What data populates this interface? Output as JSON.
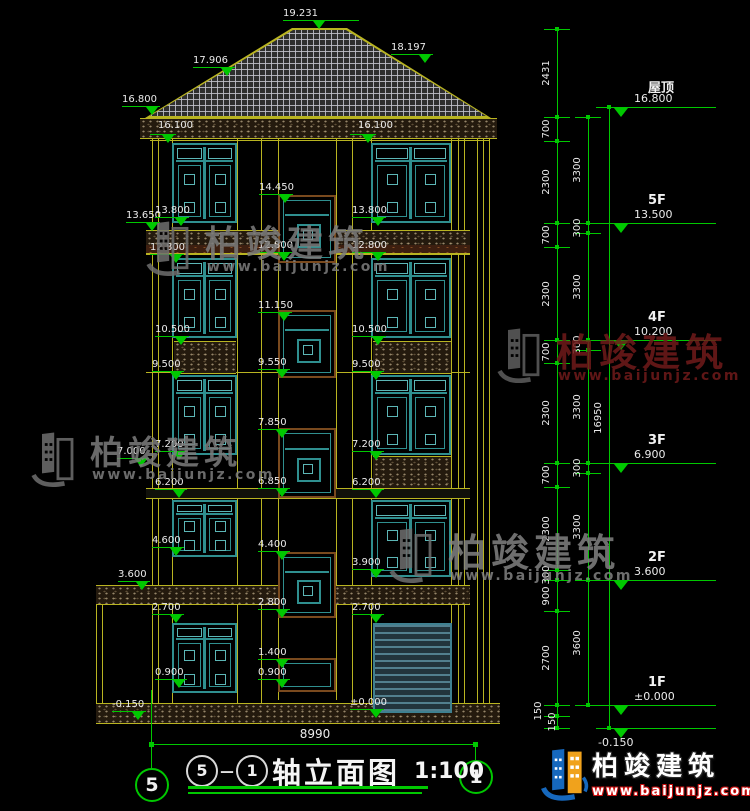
{
  "colors": {
    "bg": "#000000",
    "line_yellow": "#b9b421",
    "green": "#00c800",
    "text": "#ebebeb",
    "teal": "#2f8f8f",
    "teal_light": "#5cb6b6",
    "brown": "#7a4a1e",
    "maroon": "#701a1a",
    "gray_wm": "#7d7d7d",
    "logo_blue": "#1668bd",
    "logo_orange": "#f0a21c",
    "logo_red": "#cc1111"
  },
  "title_block": {
    "axis_left": "5",
    "dash": "－",
    "axis_right": "1",
    "name": "轴立面图",
    "scale": "1:100"
  },
  "axis_bubbles": {
    "left": "5",
    "right": "1"
  },
  "bottom_dim": "8990",
  "logo": {
    "text": "柏竣建筑",
    "url": "www.baijunjz.com"
  },
  "watermarks": [
    {
      "x": 143,
      "y": 213,
      "color": "#7d7d7d",
      "logo_color": "#6f6f6f",
      "fs": 36,
      "text": "柏竣建筑",
      "url": "www.baijunjz.com"
    },
    {
      "x": 28,
      "y": 424,
      "color": "#7d7d7d",
      "logo_color": "#6f6f6f",
      "fs": 33,
      "text": "柏竣建筑",
      "url": "www.baijunjz.com"
    },
    {
      "x": 494,
      "y": 320,
      "color": "#701a1a",
      "logo_color": "#5e5e5e",
      "fs": 38,
      "text": "柏竣建筑",
      "url": "www.baijunjz.com"
    },
    {
      "x": 386,
      "y": 520,
      "color": "#828282",
      "logo_color": "#6f6f6f",
      "fs": 38,
      "text": "柏竣建筑",
      "url": "www.baijunjz.com"
    }
  ],
  "elevation_marks": [
    {
      "t": "19.231",
      "x": 283,
      "y": 8,
      "w": 76,
      "to": 30
    },
    {
      "t": "17.906",
      "x": 193,
      "y": 55,
      "w": 42,
      "to": 28
    },
    {
      "t": "18.197",
      "x": 391,
      "y": 42,
      "w": 42,
      "to": 28
    },
    {
      "t": "16.800",
      "x": 122,
      "y": 94,
      "w": 38,
      "to": 24
    },
    {
      "t": "16.100",
      "x": 158,
      "y": 120,
      "plain": true
    },
    {
      "t": "16.100",
      "x": 358,
      "y": 120,
      "plain": true
    },
    {
      "t": "",
      "x": 150,
      "y": 122,
      "w": 26,
      "to": 12
    },
    {
      "t": "",
      "x": 350,
      "y": 122,
      "w": 26,
      "to": 12
    },
    {
      "t": "14.450",
      "x": 259,
      "y": 182,
      "w": 34
    },
    {
      "t": "13.650",
      "x": 126,
      "y": 210,
      "w": 34
    },
    {
      "t": "13.800",
      "x": 155,
      "y": 205,
      "w": 34
    },
    {
      "t": "13.800",
      "x": 352,
      "y": 205,
      "w": 34
    },
    {
      "t": "12.800",
      "x": 150,
      "y": 242,
      "w": 34
    },
    {
      "t": "12.800",
      "x": 258,
      "y": 240,
      "w": 34
    },
    {
      "t": "12.800",
      "x": 352,
      "y": 240,
      "w": 34
    },
    {
      "t": "11.150",
      "x": 258,
      "y": 300,
      "w": 34
    },
    {
      "t": "10.500",
      "x": 155,
      "y": 324,
      "w": 34
    },
    {
      "t": "10.500",
      "x": 352,
      "y": 324,
      "w": 34
    },
    {
      "t": "9.500",
      "x": 152,
      "y": 359,
      "w": 32
    },
    {
      "t": "9.550",
      "x": 258,
      "y": 357,
      "w": 32
    },
    {
      "t": "9.500",
      "x": 352,
      "y": 359,
      "w": 32
    },
    {
      "t": "7.850",
      "x": 258,
      "y": 417,
      "w": 32
    },
    {
      "t": "7.000",
      "x": 117,
      "y": 446,
      "w": 32
    },
    {
      "t": "7.200",
      "x": 155,
      "y": 439,
      "w": 32
    },
    {
      "t": "7.200",
      "x": 352,
      "y": 439,
      "w": 32
    },
    {
      "t": "6.200",
      "x": 155,
      "y": 477,
      "w": 32
    },
    {
      "t": "6.850",
      "x": 258,
      "y": 476,
      "w": 32
    },
    {
      "t": "6.200",
      "x": 352,
      "y": 477,
      "w": 32
    },
    {
      "t": "4.600",
      "x": 152,
      "y": 535,
      "w": 32
    },
    {
      "t": "4.400",
      "x": 258,
      "y": 539,
      "w": 32
    },
    {
      "t": "3.900",
      "x": 352,
      "y": 557,
      "w": 32
    },
    {
      "t": "3.600",
      "x": 118,
      "y": 569,
      "w": 32
    },
    {
      "t": "2.700",
      "x": 152,
      "y": 602,
      "w": 32
    },
    {
      "t": "2.800",
      "x": 258,
      "y": 597,
      "w": 32
    },
    {
      "t": "2.700",
      "x": 352,
      "y": 602,
      "w": 32
    },
    {
      "t": "1.400",
      "x": 258,
      "y": 647,
      "w": 32
    },
    {
      "t": "0.900",
      "x": 155,
      "y": 667,
      "w": 32
    },
    {
      "t": "0.900",
      "x": 258,
      "y": 667,
      "w": 32
    },
    {
      "t": "-0.150",
      "x": 112,
      "y": 699,
      "w": 34
    },
    {
      "t": "±0.000",
      "x": 350,
      "y": 697,
      "w": 34
    }
  ],
  "floor_levels": [
    {
      "label": "屋顶",
      "elev": "16.800",
      "ly": 107
    },
    {
      "label": "5F",
      "elev": "13.500",
      "ly": 223
    },
    {
      "label": "4F",
      "elev": "10.200",
      "ly": 340
    },
    {
      "label": "3F",
      "elev": "6.900",
      "ly": 463
    },
    {
      "label": "2F",
      "elev": "3.600",
      "ly": 580
    },
    {
      "label": "1F",
      "elev": "±0.000",
      "ly": 705
    },
    {
      "label": "",
      "elev": "-0.150",
      "ly": 728,
      "below": true
    }
  ],
  "dim_chains": [
    {
      "x": 557,
      "segs": [
        {
          "t": "2431",
          "a": 29,
          "b": 117
        },
        {
          "t": "700",
          "a": 117,
          "b": 141
        },
        {
          "t": "2300",
          "a": 141,
          "b": 223
        },
        {
          "t": "700",
          "a": 223,
          "b": 247
        },
        {
          "t": "2300",
          "a": 247,
          "b": 340
        },
        {
          "t": "700",
          "a": 340,
          "b": 363
        },
        {
          "t": "2300",
          "a": 363,
          "b": 463
        },
        {
          "t": "700",
          "a": 463,
          "b": 487
        },
        {
          "t": "2300",
          "a": 487,
          "b": 570
        },
        {
          "t": "300",
          "a": 570,
          "b": 580
        },
        {
          "t": "900",
          "a": 580,
          "b": 611
        },
        {
          "t": "2700",
          "a": 611,
          "b": 705
        },
        {
          "t": "150",
          "a": 705,
          "b": 716,
          "dx": -8
        },
        {
          "t": "150",
          "a": 716,
          "b": 728,
          "dx": 6
        }
      ]
    },
    {
      "x": 588,
      "segs": [
        {
          "t": "3300",
          "a": 117,
          "b": 223
        },
        {
          "t": "300",
          "a": 223,
          "b": 233
        },
        {
          "t": "3300",
          "a": 233,
          "b": 340
        },
        {
          "t": "300",
          "a": 340,
          "b": 350
        },
        {
          "t": "3300",
          "a": 350,
          "b": 463
        },
        {
          "t": "300",
          "a": 463,
          "b": 473
        },
        {
          "t": "3300",
          "a": 473,
          "b": 580
        },
        {
          "t": "3600",
          "a": 580,
          "b": 705
        }
      ]
    },
    {
      "x": 609,
      "segs": [
        {
          "t": "16950",
          "a": 107,
          "b": 728
        }
      ]
    }
  ],
  "drawing": {
    "vlines": [
      [
        152,
        137,
        703
      ],
      [
        158,
        137,
        703
      ],
      [
        172,
        137,
        703
      ],
      [
        237,
        137,
        703
      ],
      [
        261,
        137,
        703
      ],
      [
        278,
        137,
        700
      ],
      [
        336,
        137,
        700
      ],
      [
        352,
        137,
        703
      ],
      [
        371,
        137,
        703
      ],
      [
        451,
        137,
        703
      ],
      [
        458,
        137,
        703
      ],
      [
        464,
        137,
        703
      ],
      [
        477,
        137,
        703
      ],
      [
        483,
        137,
        703
      ],
      [
        489,
        137,
        703
      ],
      [
        96,
        585,
        722
      ],
      [
        102,
        585,
        722
      ]
    ],
    "hlines": [
      [
        150,
        140,
        340
      ],
      [
        146,
        254,
        324
      ],
      [
        146,
        372,
        324
      ],
      [
        96,
        722,
        404
      ]
    ],
    "bands": [
      {
        "x": 140,
        "y": 118,
        "w": 357,
        "h": 19,
        "kind": "speckle"
      },
      {
        "x": 146,
        "y": 230,
        "w": 324,
        "h": 15,
        "kind": "speckle"
      },
      {
        "x": 146,
        "y": 245,
        "w": 324,
        "h": 8,
        "kind": "brown"
      },
      {
        "x": 174,
        "y": 341,
        "w": 62,
        "h": 31,
        "kind": "speckle"
      },
      {
        "x": 373,
        "y": 341,
        "w": 78,
        "h": 31,
        "kind": "speckle"
      },
      {
        "x": 373,
        "y": 456,
        "w": 78,
        "h": 31,
        "kind": "speckle"
      },
      {
        "x": 146,
        "y": 488,
        "w": 324,
        "h": 9,
        "kind": "thin"
      },
      {
        "x": 96,
        "y": 585,
        "w": 374,
        "h": 18,
        "kind": "speckle"
      },
      {
        "x": 96,
        "y": 703,
        "w": 404,
        "h": 19,
        "kind": "speckle"
      }
    ],
    "windows": [
      {
        "x": 172,
        "y": 143,
        "w": 65,
        "h": 80,
        "type": "large"
      },
      {
        "x": 172,
        "y": 258,
        "w": 65,
        "h": 80,
        "type": "large"
      },
      {
        "x": 172,
        "y": 375,
        "w": 65,
        "h": 80,
        "type": "large"
      },
      {
        "x": 172,
        "y": 500,
        "w": 65,
        "h": 57,
        "type": "large"
      },
      {
        "x": 172,
        "y": 623,
        "w": 65,
        "h": 70,
        "type": "large"
      },
      {
        "x": 371,
        "y": 143,
        "w": 80,
        "h": 80,
        "type": "large"
      },
      {
        "x": 371,
        "y": 258,
        "w": 80,
        "h": 80,
        "type": "large"
      },
      {
        "x": 371,
        "y": 375,
        "w": 80,
        "h": 80,
        "type": "large"
      },
      {
        "x": 371,
        "y": 500,
        "w": 80,
        "h": 77,
        "type": "large"
      },
      {
        "x": 373,
        "y": 623,
        "w": 79,
        "h": 90,
        "type": "garage"
      },
      {
        "x": 278,
        "y": 195,
        "w": 58,
        "h": 68,
        "type": "mid"
      },
      {
        "x": 278,
        "y": 310,
        "w": 58,
        "h": 68,
        "type": "mid"
      },
      {
        "x": 278,
        "y": 428,
        "w": 58,
        "h": 70,
        "type": "mid"
      },
      {
        "x": 278,
        "y": 552,
        "w": 58,
        "h": 66,
        "type": "mid"
      },
      {
        "x": 278,
        "y": 658,
        "w": 58,
        "h": 34,
        "type": "slot"
      }
    ]
  }
}
